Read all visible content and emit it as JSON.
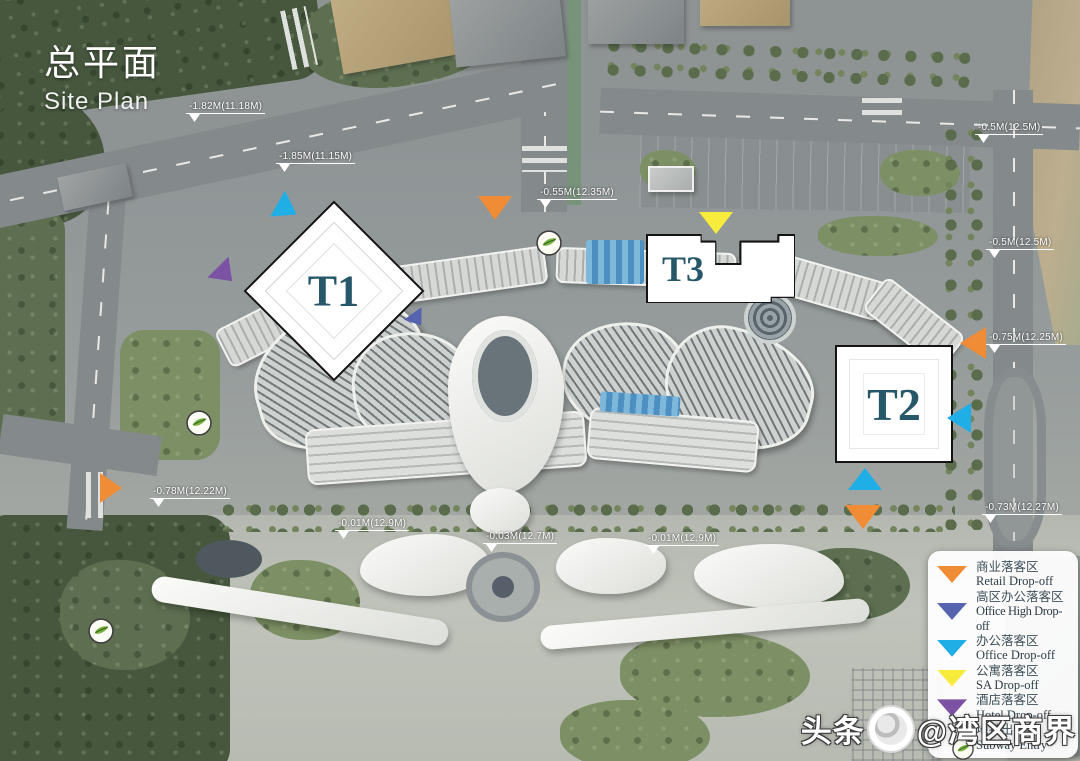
{
  "header": {
    "title_zh": "总平面",
    "title_en": "Site Plan"
  },
  "towers": {
    "t1": "T1",
    "t2": "T2",
    "t3": "T3"
  },
  "elevations": [
    "-1.82M(11.18M)",
    "-1.85M(11.15M)",
    "-0.55M(12.35M)",
    "-0.5M(12.5M)",
    "-0.5M(12.5M)",
    "-0.75M(12.25M)",
    "-0.73M(12.27M)",
    "-0.78M(12.22M)",
    "-0.01M(12.9M)",
    "-0.03M(12.7M)",
    "-0.01M(12.9M)"
  ],
  "legend": {
    "items": [
      {
        "zh": "商业落客区",
        "en": "Retail Drop-off",
        "color": "#EF8C35",
        "icon": "triangle-down"
      },
      {
        "zh": "高区办公落客区",
        "en": "Office High Drop-off",
        "color": "#5663AE",
        "icon": "triangle-down"
      },
      {
        "zh": "办公落客区",
        "en": "Office Drop-off",
        "color": "#1FAEE5",
        "icon": "triangle-down"
      },
      {
        "zh": "公寓落客区",
        "en": "SA Drop-off",
        "color": "#F7EB3C",
        "icon": "triangle-down"
      },
      {
        "zh": "酒店落客区",
        "en": "Hotel Drop-off",
        "color": "#7C52A5",
        "icon": "triangle-down"
      },
      {
        "zh": "地铁出入口",
        "en": "Subway Entry",
        "color": "#7CB342",
        "icon": "subway-circle"
      }
    ]
  },
  "watermark": {
    "prefix": "头条",
    "handle": "@湾区商界"
  }
}
